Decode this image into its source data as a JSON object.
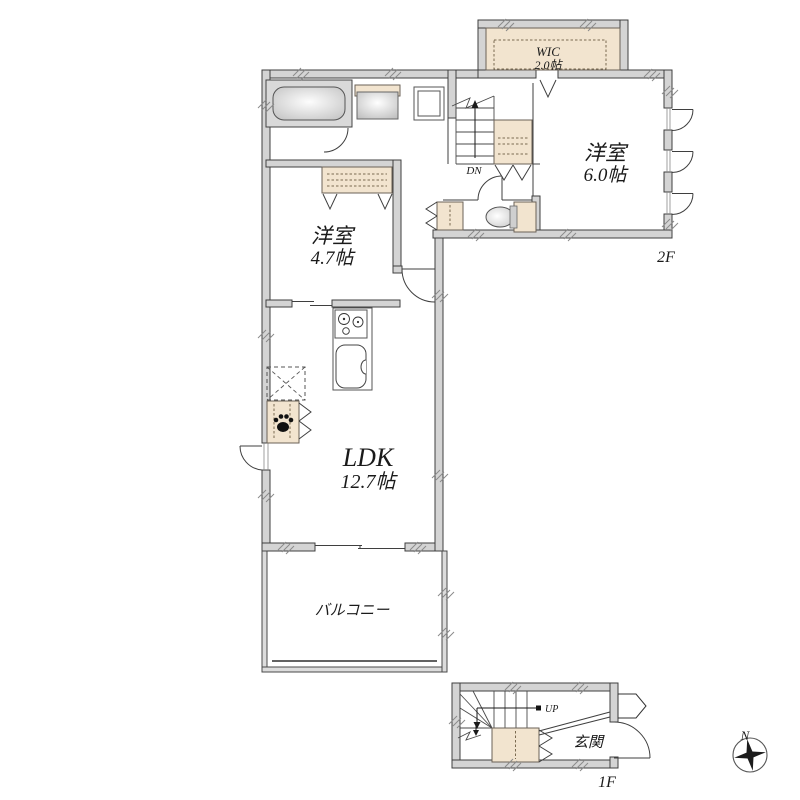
{
  "plan": {
    "floor2": {
      "floor_label": "2F",
      "wic": {
        "name": "WIC",
        "size": "2.0帖"
      },
      "bedroom_6": {
        "name": "洋室",
        "size": "6.0帖"
      },
      "bedroom_4_7": {
        "name": "洋室",
        "size": "4.7帖"
      },
      "ldk": {
        "name": "LDK",
        "size": "12.7帖"
      },
      "balcony": {
        "name": "バルコニー"
      },
      "stairs_label": "DN"
    },
    "floor1": {
      "floor_label": "1F",
      "entrance": {
        "name": "玄関"
      },
      "stairs_label": "UP"
    },
    "compass_north": "N",
    "colors": {
      "wall_fill": "#d4d4d4",
      "wall_outline": "#3f3f3f",
      "closet_fill": "#f2e4cf",
      "bath_fill": "#d9d9d9",
      "background": "#ffffff"
    }
  }
}
